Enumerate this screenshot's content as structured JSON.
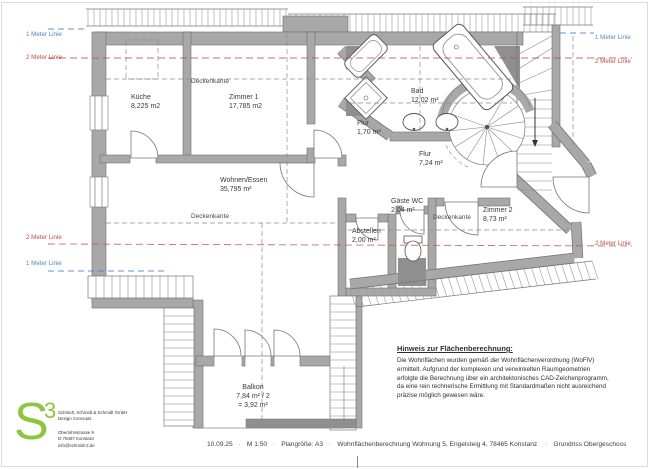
{
  "title_block": {
    "date": "10.09.25",
    "scale": "M 1:50",
    "sheet": "Plangröße: A3",
    "project": "Wohnflächenberechnung Wohnung 5, Engelsteig 4, 78465 Konstanz",
    "drawing_name": "Grundriss Obergeschoss",
    "separator": "·"
  },
  "note": {
    "title": "Hinweis zur Flächenberechnung:",
    "body": "Die Wohnflächen wurden gemäß der Wohnflächenverordnung (WoFlV) ermittelt. Aufgrund der komplexen und verwinkelten Raumgeometrien erfolgte die Berechnung über ein architektonisches CAD-Zeichenprogramm, da eine rein rechnerische Ermittlung mit Standardmaßen nicht ausreichend präzise möglich gewesen wäre."
  },
  "logo": {
    "letter": "S",
    "superscript": "3",
    "company_line1": "Schmidt, Schmidt & Schmidt GmbH",
    "company_line2": "Design Concepts",
    "address_line1": "Oberlohnstrasse 9",
    "address_line2": "D-78467 Konstanz",
    "address_line3": "info@schmidt-3.de",
    "accent_color": "#8cc63e"
  },
  "rooms": [
    {
      "name": "Küche",
      "area": "8,225 m2",
      "x": 131,
      "y": 93,
      "align": "left"
    },
    {
      "name": "Zimmer 1",
      "area": "17,785 m2",
      "x": 229,
      "y": 93,
      "align": "left"
    },
    {
      "name": "Wohnen/Essen",
      "area": "35,795 m²",
      "x": 220,
      "y": 176,
      "align": "left"
    },
    {
      "name": "Flur",
      "area": "1,70 m²",
      "x": 357,
      "y": 119,
      "align": "left"
    },
    {
      "name": "Bad",
      "area": "12,02 m²",
      "x": 411,
      "y": 87,
      "align": "left"
    },
    {
      "name": "Flur",
      "area": "7,24 m²",
      "x": 419,
      "y": 150,
      "align": "left"
    },
    {
      "name": "Gäste WC",
      "area": "2,04 m²",
      "x": 391,
      "y": 197,
      "align": "left"
    },
    {
      "name": "Abstellen",
      "area": "2,00 m²",
      "x": 352,
      "y": 227,
      "align": "left"
    },
    {
      "name": "Zimmer 2",
      "area": "8,73 m²",
      "x": 483,
      "y": 206,
      "align": "left"
    },
    {
      "name": "Balkon",
      "area": "7,84 m² / 2",
      "area2": "= 3,92 m²",
      "x": 253,
      "y": 383,
      "align": "center"
    }
  ],
  "annotations": {
    "deckenkante": "Deckenkante",
    "ceiling_labels": [
      {
        "x": 191,
        "y": 78
      },
      {
        "x": 191,
        "y": 213
      },
      {
        "x": 433,
        "y": 214
      }
    ],
    "guide_labels": [
      {
        "text": "1 Meter Linie",
        "color": "blue",
        "x": 26,
        "y": 31
      },
      {
        "text": "2 Meter Linie",
        "color": "red",
        "x": 26,
        "y": 54
      },
      {
        "text": "1 Meter Linie",
        "color": "blue",
        "x": 595,
        "y": 34
      },
      {
        "text": "2 Meter Linie",
        "color": "red",
        "x": 595,
        "y": 58
      },
      {
        "text": "2 Meter Linie",
        "color": "red",
        "x": 26,
        "y": 234
      },
      {
        "text": "1 Meter Linie",
        "color": "blue",
        "x": 26,
        "y": 260
      },
      {
        "text": "2 Meter Linie",
        "color": "red",
        "x": 595,
        "y": 240
      }
    ]
  },
  "colors": {
    "guide_blue": "#4f86c0",
    "guide_red": "#bf4a47"
  }
}
